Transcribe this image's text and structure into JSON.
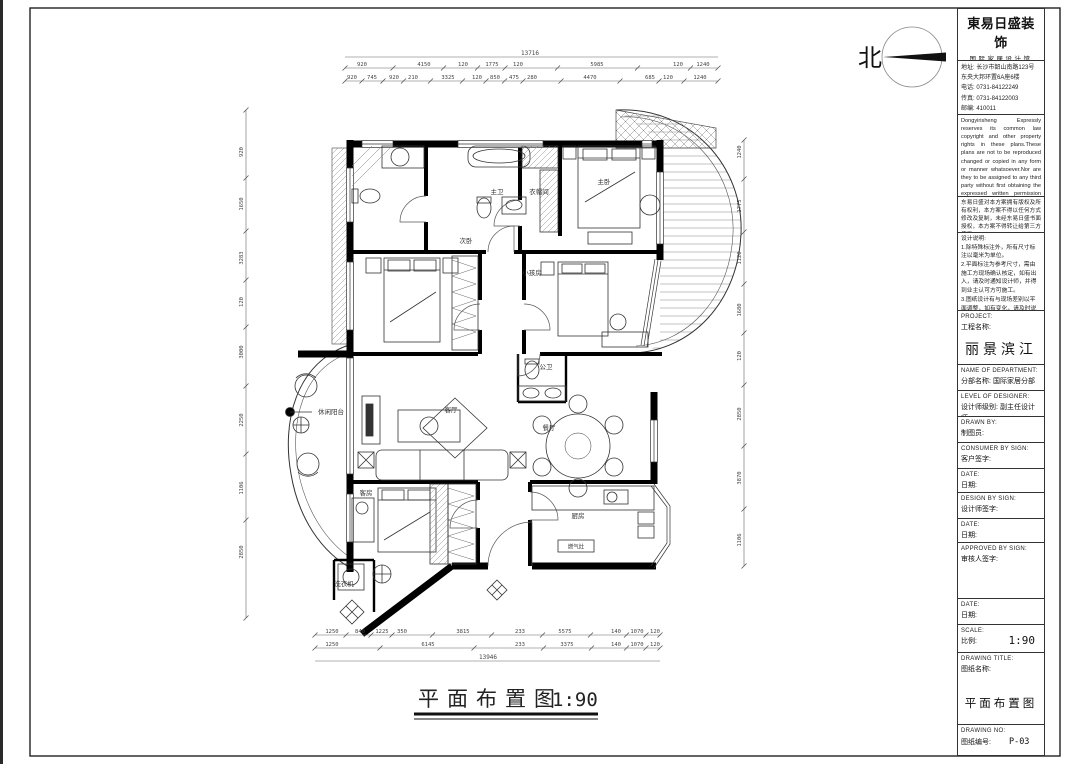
{
  "sheet": {
    "north_label": "北"
  },
  "footer": {
    "title": "平面布置图",
    "scale": "1:90"
  },
  "logo": {
    "name": "東易日盛装饰",
    "sub": "国际家居设计馆",
    "company": "东易日盛家居装饰集团股份有限公司",
    "address_lines": [
      "地址: 长沙市韶山南路123号",
      "东央大邦环置6A座6楼",
      "电话: 0731-84122249",
      "传真: 0731-84122003",
      "邮编: 410011",
      "http://www.dyrs.com.cn"
    ]
  },
  "legal": {
    "en": "Dongyirisheng Expressly reserves its common law copyright and other property rights in these plans.These plans are not to be reproduced changed or copied in any form or manner whatsoever.Nor are they to be assigned to any third party without first obtaining the expressed written permission and consent of Dongyirisheng",
    "cn": "东易日盛对本方案拥有版权及所有权利，本方案不得以任何方式修改及复制，未经东易日盛书面授权，本方案不得转让给第三方使用。"
  },
  "notes": "设计说明:\n1.除特殊标注外，所有尺寸标注以毫米为单位。\n2.平面标注为参考尺寸，需由施工方现场确认核定，如有出入，请及时通知设计师，并得到业主认可方可施工。\n3.图纸设计有与现场差别以平面调整，如有变化，请及时说明。\n4.实际施工为准施工图纸，须经（客户确认签字）后方可按图施工。",
  "tb": {
    "project": {
      "en": "PROJECT:",
      "cn": "工程名称:",
      "value": "丽景滨江"
    },
    "department": {
      "en": "NAME OF DEPARTMENT:",
      "cn": "分部名称:",
      "value": "国际家居分部"
    },
    "level": {
      "en": "LEVEL OF DESIGNER:",
      "cn": "设计师级别:",
      "value": "副主任设计师"
    },
    "drawn": {
      "en": "DRAWN BY:",
      "cn": "制图员:"
    },
    "consumer": {
      "en": "CONSUMER BY SIGN:",
      "cn": "客户签字:"
    },
    "date1": {
      "en": "DATE:",
      "cn": "日期:"
    },
    "design": {
      "en": "DESIGN BY SIGN:",
      "cn": "设计师签字:"
    },
    "date2": {
      "en": "DATE:",
      "cn": "日期:"
    },
    "approved": {
      "en": "APPROVED BY SIGN:",
      "cn": "审核人签字:"
    },
    "date3": {
      "en": "DATE:",
      "cn": "日期:"
    },
    "scale": {
      "en": "SCALE:",
      "cn": "比例:",
      "value": "1:90"
    },
    "title": {
      "en": "DRAWING TITLE:",
      "cn": "图纸名称:",
      "value": "平面布置图"
    },
    "no": {
      "en": "DRAWING NO:",
      "cn": "图纸编号:",
      "value": "P-03"
    }
  },
  "plan": {
    "stove_label": "燃气灶",
    "rooms": [
      {
        "label": "主卫",
        "x": 497,
        "y": 194
      },
      {
        "label": "衣帽间",
        "x": 539,
        "y": 194
      },
      {
        "label": "主卧",
        "x": 604,
        "y": 184
      },
      {
        "label": "次卧",
        "x": 466,
        "y": 243
      },
      {
        "label": "小孩房",
        "x": 532,
        "y": 275
      },
      {
        "label": "公卫",
        "x": 546,
        "y": 369
      },
      {
        "label": "餐厅",
        "x": 549,
        "y": 430
      },
      {
        "label": "客厅",
        "x": 451,
        "y": 412
      },
      {
        "label": "休闲阳台",
        "x": 331,
        "y": 414
      },
      {
        "label": "客房",
        "x": 366,
        "y": 495
      },
      {
        "label": "厨房",
        "x": 578,
        "y": 518
      },
      {
        "label": "洗衣机",
        "x": 344,
        "y": 586
      }
    ],
    "dims": {
      "top_total": "13716",
      "bottom_total": "13946",
      "top1": [
        {
          "x": 362,
          "t": "920"
        },
        {
          "x": 424,
          "t": "4150"
        },
        {
          "x": 463,
          "t": "120"
        },
        {
          "x": 492,
          "t": "1775"
        },
        {
          "x": 518,
          "t": "120"
        },
        {
          "x": 597,
          "t": "5985"
        },
        {
          "x": 678,
          "t": "120"
        },
        {
          "x": 703,
          "t": "1240"
        }
      ],
      "top2": [
        {
          "x": 352,
          "t": "920"
        },
        {
          "x": 372,
          "t": "745"
        },
        {
          "x": 394,
          "t": "920"
        },
        {
          "x": 413,
          "t": "210"
        },
        {
          "x": 448,
          "t": "3325"
        },
        {
          "x": 477,
          "t": "120"
        },
        {
          "x": 495,
          "t": "850"
        },
        {
          "x": 514,
          "t": "475"
        },
        {
          "x": 532,
          "t": "280"
        },
        {
          "x": 590,
          "t": "4470"
        },
        {
          "x": 650,
          "t": "685"
        },
        {
          "x": 668,
          "t": "120"
        },
        {
          "x": 700,
          "t": "1240"
        }
      ],
      "bottom1": [
        {
          "x": 332,
          "t": "1250"
        },
        {
          "x": 360,
          "t": "840"
        },
        {
          "x": 382,
          "t": "1225"
        },
        {
          "x": 402,
          "t": "350"
        },
        {
          "x": 463,
          "t": "3815"
        },
        {
          "x": 520,
          "t": "233"
        },
        {
          "x": 565,
          "t": "5575"
        },
        {
          "x": 616,
          "t": "140"
        },
        {
          "x": 637,
          "t": "1070"
        },
        {
          "x": 655,
          "t": "120"
        }
      ],
      "bottom2": [
        {
          "x": 332,
          "t": "1250"
        },
        {
          "x": 428,
          "t": "6145"
        },
        {
          "x": 520,
          "t": "233"
        },
        {
          "x": 567,
          "t": "3375"
        },
        {
          "x": 616,
          "t": "140"
        },
        {
          "x": 637,
          "t": "1070"
        },
        {
          "x": 655,
          "t": "120"
        }
      ],
      "left": [
        {
          "y": 152,
          "t": "920"
        },
        {
          "y": 204,
          "t": "1650"
        },
        {
          "y": 258,
          "t": "3283"
        },
        {
          "y": 302,
          "t": "120"
        },
        {
          "y": 352,
          "t": "3000"
        },
        {
          "y": 420,
          "t": "2250"
        },
        {
          "y": 488,
          "t": "1106"
        },
        {
          "y": 552,
          "t": "2850"
        }
      ],
      "right": [
        {
          "y": 152,
          "t": "1240"
        },
        {
          "y": 206,
          "t": "1775"
        },
        {
          "y": 258,
          "t": "1120"
        },
        {
          "y": 310,
          "t": "1680"
        },
        {
          "y": 356,
          "t": "120"
        },
        {
          "y": 414,
          "t": "2850"
        },
        {
          "y": 478,
          "t": "3870"
        },
        {
          "y": 540,
          "t": "1106"
        }
      ]
    }
  }
}
